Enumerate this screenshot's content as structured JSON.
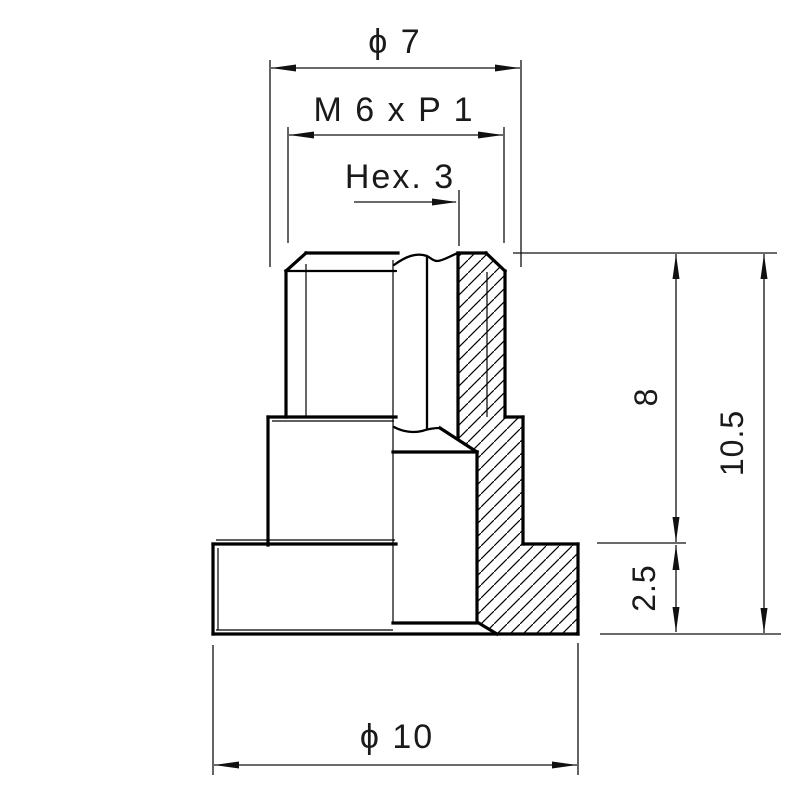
{
  "drawing": {
    "background": "#ffffff",
    "line_color": "#000000",
    "text_color": "#1a1a1a",
    "dimensions": {
      "top_diameter": "ϕ 7",
      "thread": "M 6 x P 1",
      "hex_socket": "Hex. 3",
      "body_height": "8",
      "total_height": "10.5",
      "flange_thickness": "2.5",
      "flange_diameter": "ϕ 10"
    }
  }
}
